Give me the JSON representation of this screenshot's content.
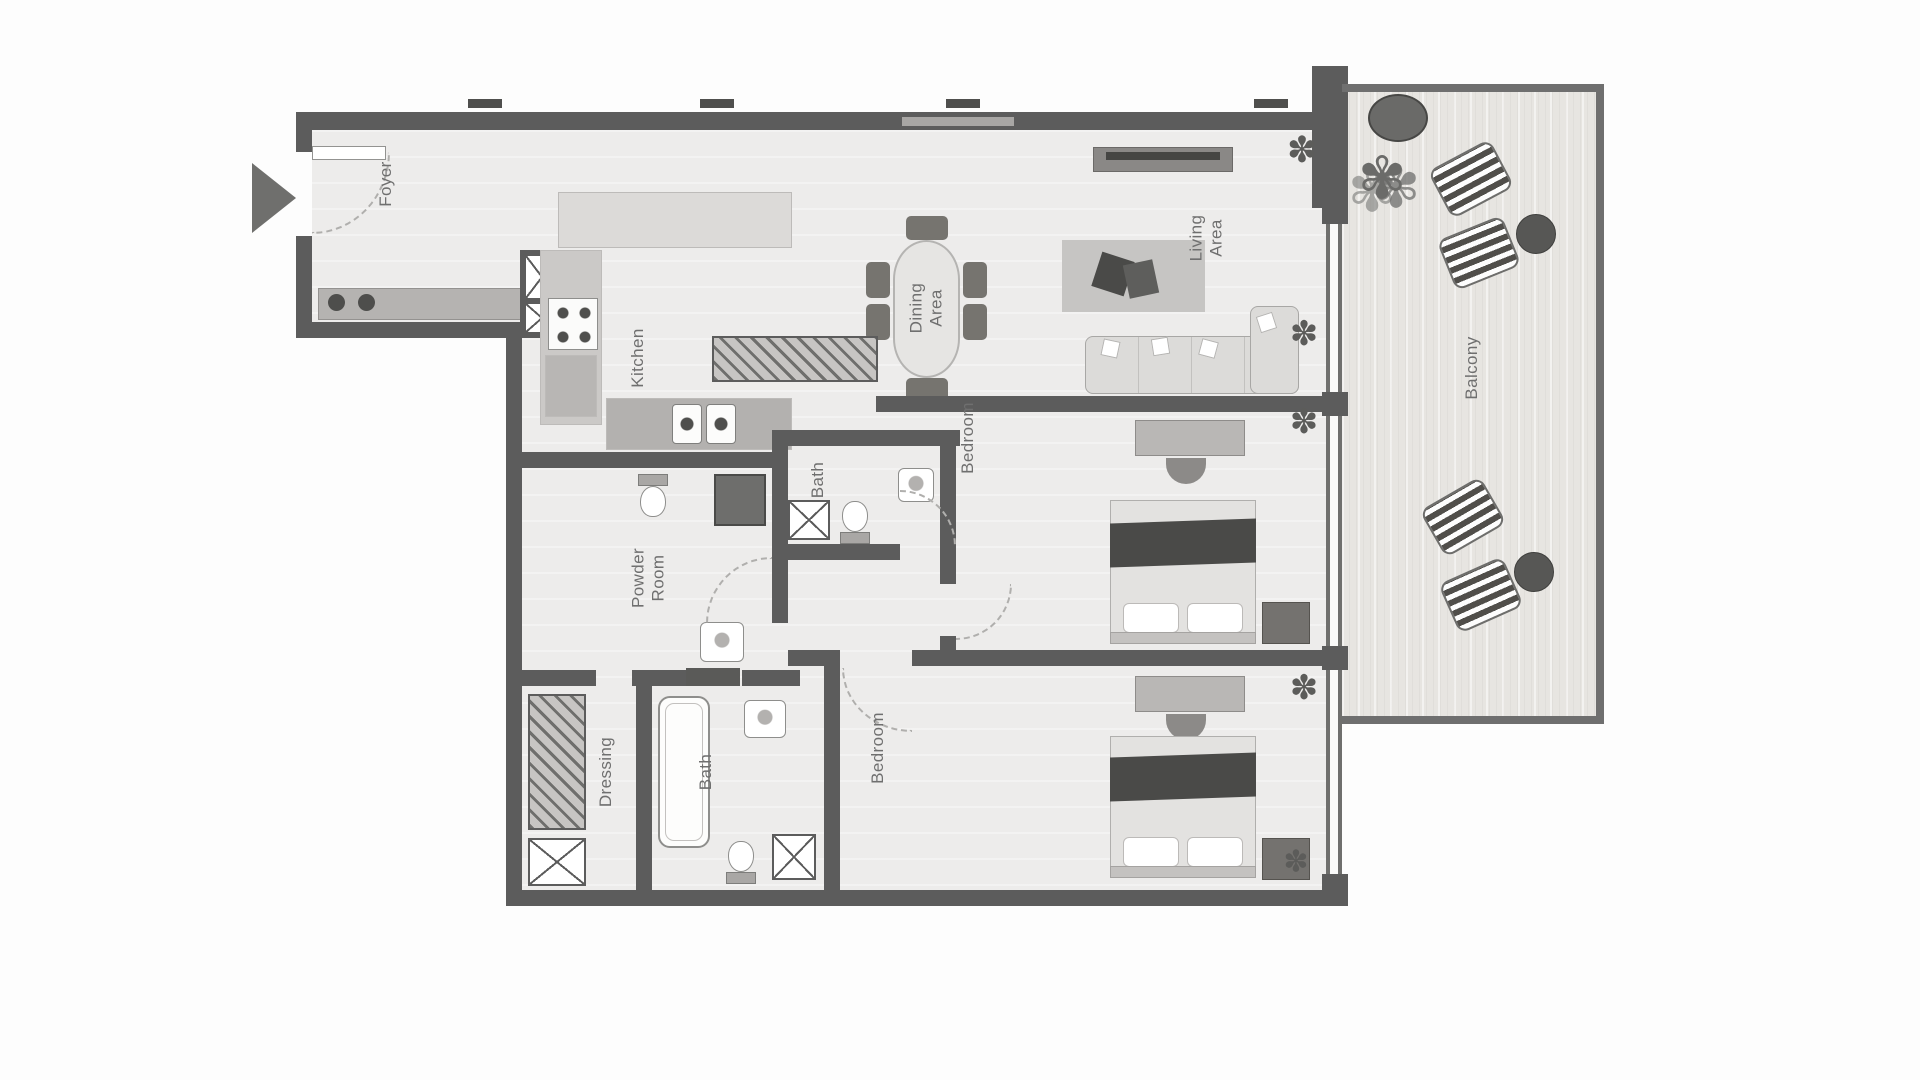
{
  "rooms": {
    "foyer": {
      "label": "Foyer"
    },
    "kitchen": {
      "label": "Kitchen"
    },
    "dining": {
      "label": "Dining Area"
    },
    "living": {
      "label": "Living Area"
    },
    "powder": {
      "label": "Powder Room"
    },
    "bath_top": {
      "label": "Bath"
    },
    "bedroom_top": {
      "label": "Bedroom"
    },
    "dressing": {
      "label": "Dressing"
    },
    "bath_bottom": {
      "label": "Bath"
    },
    "bedroom_bottom": {
      "label": "Bedroom"
    },
    "balcony": {
      "label": "Balcony"
    }
  },
  "icons": {
    "plant": "✽",
    "bush": "✾"
  },
  "colors": {
    "wall": "#5c5c5c",
    "floor": "#edeceb",
    "balcony_floor": "#e7e5e1",
    "furniture_dark": "#6a6a68",
    "label_text": "#6f6f6f"
  }
}
